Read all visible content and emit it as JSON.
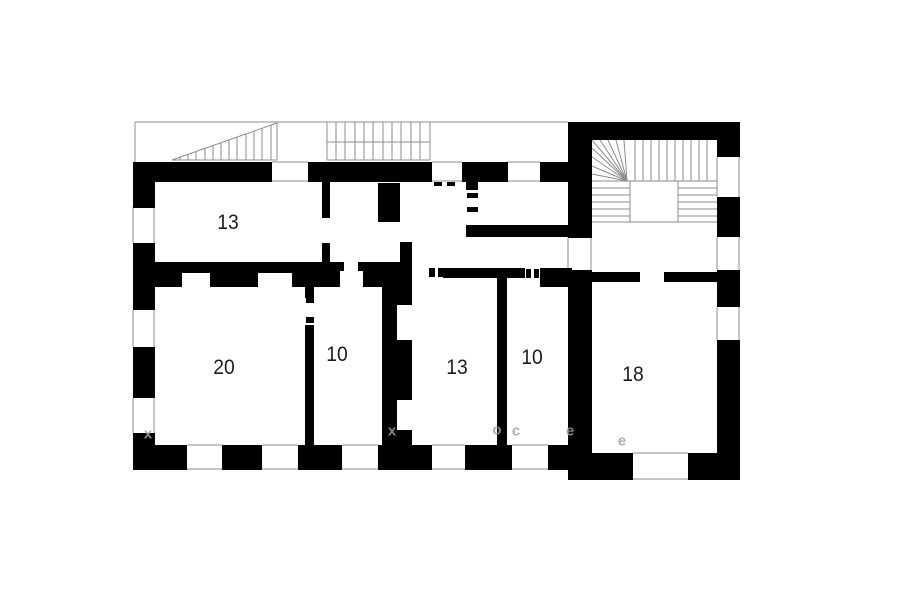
{
  "title": "apartment-floor-plan",
  "colors": {
    "wall": "#000000",
    "thin_line": "#8c8c8c",
    "label": "#1c1c1c",
    "watermark": "#9e9e9e",
    "background": "#ffffff"
  },
  "rooms": [
    {
      "label": "13",
      "x": 228,
      "y": 223
    },
    {
      "label": "20",
      "x": 224,
      "y": 368
    },
    {
      "label": "10",
      "x": 337,
      "y": 355
    },
    {
      "label": "13",
      "x": 457,
      "y": 368
    },
    {
      "label": "10",
      "x": 532,
      "y": 358
    },
    {
      "label": "18",
      "x": 633,
      "y": 375
    }
  ],
  "watermarks": [
    {
      "t": "x",
      "x": 148,
      "y": 434
    },
    {
      "t": "x",
      "x": 392,
      "y": 431
    },
    {
      "t": "o",
      "x": 497,
      "y": 430
    },
    {
      "t": "c",
      "x": 516,
      "y": 431
    },
    {
      "t": "e",
      "x": 570,
      "y": 431
    },
    {
      "t": "e",
      "x": 622,
      "y": 441
    }
  ],
  "plan": {
    "walls": [
      [
        133,
        162,
        22,
        46
      ],
      [
        133,
        243,
        22,
        67
      ],
      [
        133,
        347,
        22,
        51
      ],
      [
        133,
        433,
        22,
        37
      ],
      [
        133,
        162,
        139,
        20
      ],
      [
        308,
        162,
        124,
        20
      ],
      [
        462,
        162,
        46,
        20
      ],
      [
        540,
        162,
        30,
        20
      ],
      [
        133,
        445,
        54,
        25
      ],
      [
        222,
        445,
        40,
        25
      ],
      [
        298,
        445,
        44,
        25
      ],
      [
        378,
        445,
        54,
        25
      ],
      [
        465,
        445,
        47,
        25
      ],
      [
        548,
        445,
        24,
        25
      ],
      [
        568,
        122,
        149,
        18
      ],
      [
        717,
        122,
        23,
        35
      ],
      [
        717,
        197,
        23,
        40
      ],
      [
        717,
        270,
        23,
        37
      ],
      [
        717,
        340,
        23,
        140
      ],
      [
        568,
        122,
        24,
        116
      ],
      [
        568,
        270,
        24,
        210
      ],
      [
        592,
        453,
        41,
        27
      ],
      [
        688,
        453,
        52,
        27
      ],
      [
        592,
        272,
        46,
        10
      ],
      [
        667,
        272,
        50,
        10
      ],
      [
        322,
        182,
        8,
        36
      ],
      [
        322,
        243,
        8,
        19
      ],
      [
        378,
        183,
        22,
        39
      ],
      [
        400,
        242,
        12,
        20
      ],
      [
        382,
        262,
        30,
        183
      ],
      [
        155,
        262,
        103,
        25
      ],
      [
        258,
        262,
        34,
        11
      ],
      [
        292,
        262,
        48,
        25
      ],
      [
        363,
        262,
        19,
        25
      ],
      [
        443,
        268,
        82,
        10
      ],
      [
        540,
        268,
        32,
        19
      ],
      [
        305,
        287,
        9,
        11
      ],
      [
        305,
        325,
        9,
        120
      ],
      [
        497,
        277,
        10,
        168
      ],
      [
        466,
        180,
        12,
        10
      ],
      [
        466,
        225,
        12,
        12
      ],
      [
        475,
        225,
        93,
        12
      ]
    ],
    "white_notches": [
      [
        397,
        305,
        15,
        35
      ],
      [
        397,
        400,
        15,
        30
      ],
      [
        182,
        273,
        28,
        14
      ]
    ],
    "dashes": [
      [
        339,
        262,
        5,
        9
      ],
      [
        358,
        262,
        5,
        9
      ],
      [
        429,
        268,
        6,
        9
      ],
      [
        438,
        268,
        5,
        9
      ],
      [
        526,
        269,
        5,
        9
      ],
      [
        534,
        269,
        5,
        9
      ],
      [
        306,
        298,
        8,
        5
      ],
      [
        306,
        317,
        8,
        6
      ],
      [
        467,
        193,
        11,
        5
      ],
      [
        467,
        207,
        11,
        5
      ],
      [
        434,
        182,
        8,
        4
      ],
      [
        447,
        182,
        8,
        4
      ],
      [
        636,
        272,
        4,
        10
      ],
      [
        664,
        272,
        4,
        10
      ]
    ],
    "lines": [
      [
        135,
        122,
        568,
        122
      ],
      [
        135,
        122,
        135,
        162
      ],
      [
        172,
        160,
        277,
        123
      ],
      [
        277,
        123,
        277,
        160
      ],
      [
        172,
        160,
        277,
        160
      ],
      [
        180,
        157,
        180,
        160
      ],
      [
        188,
        154,
        188,
        160
      ],
      [
        196,
        152,
        196,
        160
      ],
      [
        205,
        148,
        205,
        160
      ],
      [
        213,
        146,
        213,
        160
      ],
      [
        221,
        143,
        221,
        160
      ],
      [
        229,
        140,
        229,
        160
      ],
      [
        237,
        137,
        237,
        160
      ],
      [
        246,
        134,
        246,
        160
      ],
      [
        254,
        131,
        254,
        160
      ],
      [
        262,
        128,
        262,
        160
      ],
      [
        271,
        125,
        271,
        160
      ],
      [
        327,
        142,
        430,
        142
      ],
      [
        327,
        160,
        430,
        160
      ],
      [
        327,
        122,
        327,
        160
      ],
      [
        336,
        122,
        336,
        160
      ],
      [
        345,
        122,
        345,
        160
      ],
      [
        355,
        122,
        355,
        160
      ],
      [
        364,
        122,
        364,
        160
      ],
      [
        373,
        122,
        373,
        160
      ],
      [
        383,
        122,
        383,
        160
      ],
      [
        392,
        122,
        392,
        160
      ],
      [
        401,
        122,
        401,
        160
      ],
      [
        411,
        122,
        411,
        160
      ],
      [
        420,
        122,
        420,
        160
      ],
      [
        430,
        122,
        430,
        160
      ],
      [
        592,
        181,
        717,
        181
      ],
      [
        592,
        222,
        717,
        222
      ],
      [
        630,
        181,
        630,
        222
      ],
      [
        678,
        181,
        678,
        222
      ],
      [
        635,
        140,
        635,
        181
      ],
      [
        643,
        140,
        643,
        181
      ],
      [
        651,
        140,
        651,
        181
      ],
      [
        659,
        140,
        659,
        181
      ],
      [
        667,
        140,
        667,
        181
      ],
      [
        675,
        140,
        675,
        181
      ],
      [
        683,
        140,
        683,
        181
      ],
      [
        691,
        140,
        691,
        181
      ],
      [
        699,
        140,
        699,
        181
      ],
      [
        707,
        140,
        707,
        181
      ],
      [
        627,
        181,
        592,
        140
      ],
      [
        627,
        181,
        600,
        140
      ],
      [
        627,
        181,
        608,
        140
      ],
      [
        627,
        181,
        616,
        140
      ],
      [
        627,
        181,
        624,
        140
      ],
      [
        627,
        181,
        592,
        148
      ],
      [
        627,
        181,
        592,
        157
      ],
      [
        627,
        181,
        592,
        166
      ],
      [
        627,
        181,
        592,
        174
      ],
      [
        592,
        188,
        630,
        188
      ],
      [
        592,
        195,
        630,
        195
      ],
      [
        592,
        202,
        630,
        202
      ],
      [
        592,
        209,
        630,
        209
      ],
      [
        592,
        216,
        630,
        216
      ],
      [
        678,
        188,
        717,
        188
      ],
      [
        678,
        195,
        717,
        195
      ],
      [
        678,
        202,
        717,
        202
      ],
      [
        678,
        209,
        717,
        209
      ],
      [
        678,
        216,
        717,
        216
      ],
      [
        272,
        162,
        308,
        162
      ],
      [
        272,
        181,
        308,
        181
      ],
      [
        432,
        162,
        462,
        162
      ],
      [
        432,
        181,
        462,
        181
      ],
      [
        507,
        162,
        540,
        162
      ],
      [
        507,
        181,
        540,
        181
      ],
      [
        133,
        207,
        133,
        243
      ],
      [
        154,
        207,
        154,
        243
      ],
      [
        133,
        310,
        133,
        347
      ],
      [
        154,
        310,
        154,
        347
      ],
      [
        133,
        398,
        133,
        433
      ],
      [
        154,
        398,
        154,
        433
      ],
      [
        187,
        445,
        222,
        445
      ],
      [
        187,
        469,
        222,
        469
      ],
      [
        262,
        445,
        298,
        445
      ],
      [
        262,
        469,
        298,
        469
      ],
      [
        342,
        445,
        378,
        445
      ],
      [
        342,
        469,
        378,
        469
      ],
      [
        432,
        445,
        465,
        445
      ],
      [
        432,
        469,
        465,
        469
      ],
      [
        512,
        445,
        548,
        445
      ],
      [
        512,
        469,
        548,
        469
      ],
      [
        717,
        157,
        717,
        197
      ],
      [
        739,
        157,
        739,
        197
      ],
      [
        717,
        237,
        717,
        270
      ],
      [
        739,
        237,
        739,
        270
      ],
      [
        717,
        307,
        717,
        340
      ],
      [
        739,
        307,
        739,
        340
      ],
      [
        633,
        453,
        688,
        453
      ],
      [
        633,
        479,
        688,
        479
      ],
      [
        568,
        237,
        568,
        270
      ],
      [
        591,
        237,
        591,
        270
      ]
    ]
  }
}
